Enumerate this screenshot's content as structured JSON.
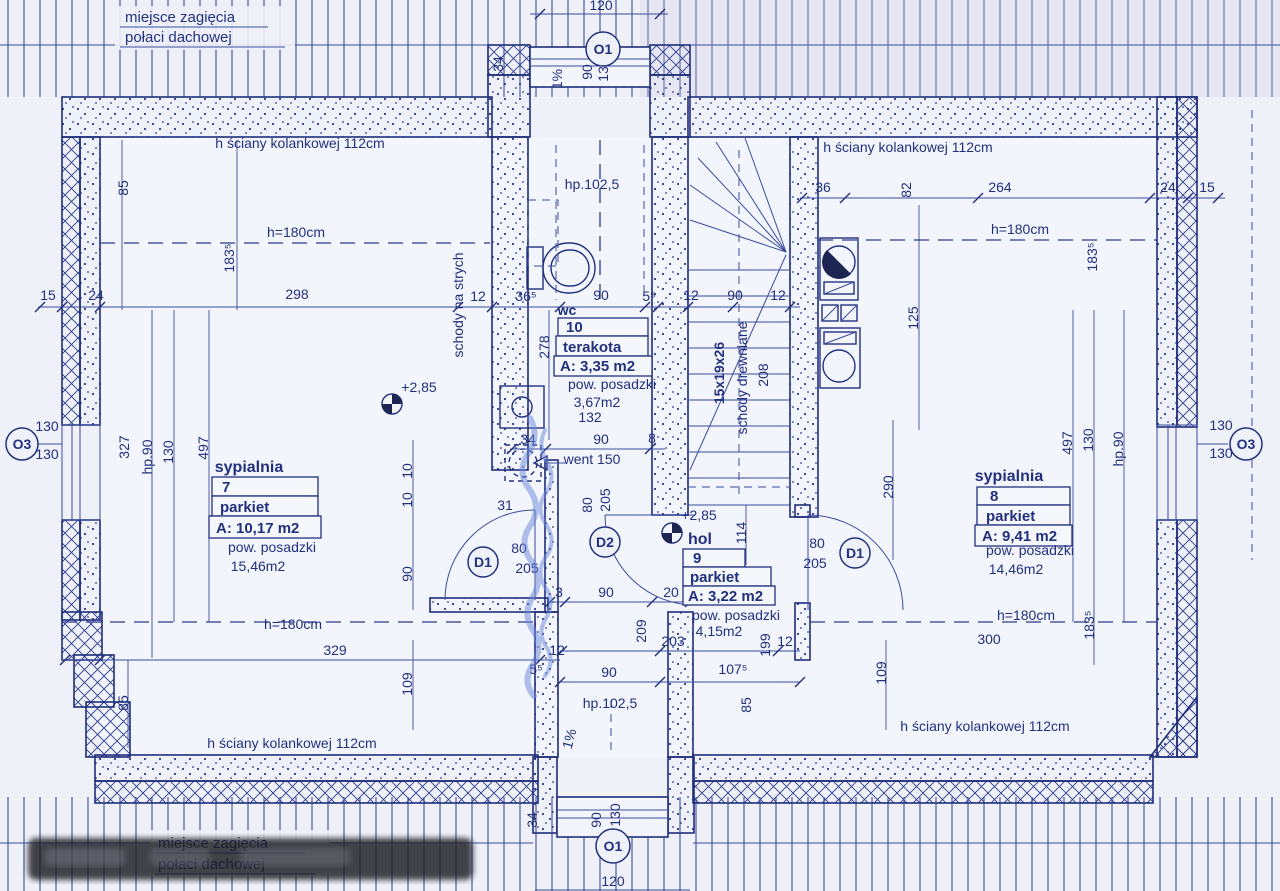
{
  "palette": {
    "paper": "#eef1f8",
    "ink": "#22307e",
    "line_light": "#3c4c9e",
    "watermark_blue": "#6b86d8",
    "redaction_dark": "#1b1c20"
  },
  "corner_notes": {
    "top_line1": "miejsce zagięcia",
    "top_line2": "połaci dachowej",
    "bottom_line1": "miejsce zagięcia",
    "bottom_line2": "połaci dachowej"
  },
  "rooms": [
    {
      "number": "7",
      "name": "sypialnia",
      "floor": "parkiet",
      "area": "A: 10,17 m2",
      "area_label": "pow. posadzki",
      "floor_area": "15,46m2"
    },
    {
      "number": "8",
      "name": "sypialnia",
      "floor": "parkiet",
      "area": "A: 9,41 m2",
      "area_label": "pow. posadzki",
      "floor_area": "14,46m2"
    },
    {
      "number": "9",
      "name": "hol",
      "floor": "parkiet",
      "area": "A: 3,22 m2",
      "area_label": "pow. posadzki",
      "floor_area": "4,15m2"
    },
    {
      "number": "10",
      "name": "wc",
      "floor": "terakota",
      "area": "A: 3,35 m2",
      "area_label": "pow. posadzki",
      "floor_area": "3,67m2"
    }
  ],
  "annotations": [
    {
      "t": "120",
      "x": 601,
      "y": 10,
      "fs": 15
    },
    {
      "t": "90",
      "x": 592,
      "y": 72,
      "r": -90,
      "fs": 15
    },
    {
      "t": "130",
      "x": 608,
      "y": 70,
      "r": -90,
      "fs": 15
    },
    {
      "t": "1%",
      "x": 562,
      "y": 79,
      "r": -90,
      "fs": 14
    },
    {
      "t": "34",
      "x": 503,
      "y": 64,
      "r": -90,
      "fs": 14
    },
    {
      "t": "h ściany kolankowej 112cm",
      "x": 300,
      "y": 148,
      "fs": 15
    },
    {
      "t": "h ściany kolankowej 112cm",
      "x": 908,
      "y": 152,
      "fs": 15
    },
    {
      "t": "hp.102,5",
      "x": 592,
      "y": 189,
      "fs": 15
    },
    {
      "t": "85",
      "x": 128,
      "y": 188,
      "r": -90,
      "fs": 14
    },
    {
      "t": "183⁵",
      "x": 234,
      "y": 258,
      "r": -90,
      "fs": 14
    },
    {
      "t": "h=180cm",
      "x": 296,
      "y": 237,
      "fs": 15
    },
    {
      "t": "h=180cm",
      "x": 1020,
      "y": 234,
      "fs": 15
    },
    {
      "t": "183⁵",
      "x": 1097,
      "y": 257,
      "r": -90,
      "fs": 14
    },
    {
      "t": "36",
      "x": 823,
      "y": 192,
      "fs": 14
    },
    {
      "t": "82",
      "x": 911,
      "y": 190,
      "r": -90,
      "fs": 14
    },
    {
      "t": "264",
      "x": 1000,
      "y": 192,
      "fs": 14
    },
    {
      "t": "24",
      "x": 1168,
      "y": 192,
      "fs": 13
    },
    {
      "t": "15",
      "x": 1207,
      "y": 192,
      "fs": 13
    },
    {
      "t": "15",
      "x": 48,
      "y": 300,
      "fs": 14
    },
    {
      "t": "24",
      "x": 96,
      "y": 300,
      "fs": 14
    },
    {
      "t": "298",
      "x": 297,
      "y": 299,
      "fs": 15
    },
    {
      "t": "12",
      "x": 478,
      "y": 301,
      "fs": 13
    },
    {
      "t": "36⁵",
      "x": 526,
      "y": 301,
      "fs": 13
    },
    {
      "t": "90",
      "x": 601,
      "y": 300,
      "fs": 14
    },
    {
      "t": "5⁵",
      "x": 649,
      "y": 301,
      "fs": 13
    },
    {
      "t": "12",
      "x": 691,
      "y": 300,
      "fs": 13
    },
    {
      "t": "90",
      "x": 735,
      "y": 300,
      "fs": 14
    },
    {
      "t": "12",
      "x": 778,
      "y": 300,
      "fs": 13
    },
    {
      "t": "wc",
      "x": 567,
      "y": 315,
      "fs": 14,
      "b": true
    },
    {
      "t": "schody na strych",
      "x": 463,
      "y": 305,
      "r": -90,
      "fs": 13
    },
    {
      "t": "125",
      "x": 918,
      "y": 318,
      "r": -90,
      "fs": 14
    },
    {
      "t": "290",
      "x": 893,
      "y": 487,
      "r": -90,
      "fs": 14
    },
    {
      "t": "15x19x26",
      "x": 724,
      "y": 373,
      "r": -90,
      "fs": 15,
      "b": true
    },
    {
      "t": "schody drewniane",
      "x": 747,
      "y": 378,
      "r": -90,
      "fs": 13
    },
    {
      "t": "208",
      "x": 768,
      "y": 375,
      "r": -90,
      "fs": 13
    },
    {
      "t": "278",
      "x": 549,
      "y": 347,
      "r": -90,
      "fs": 13
    },
    {
      "t": "hp.90",
      "x": 152,
      "y": 457,
      "r": -90,
      "fs": 13
    },
    {
      "t": "130",
      "x": 173,
      "y": 452,
      "r": -90,
      "fs": 13
    },
    {
      "t": "497",
      "x": 208,
      "y": 448,
      "r": -90,
      "fs": 13
    },
    {
      "t": "327",
      "x": 129,
      "y": 447,
      "r": -90,
      "fs": 13
    },
    {
      "t": "130",
      "x": 47,
      "y": 431,
      "fs": 13
    },
    {
      "t": "130",
      "x": 47,
      "y": 459,
      "fs": 13
    },
    {
      "t": "130",
      "x": 1221,
      "y": 430,
      "fs": 13
    },
    {
      "t": "130",
      "x": 1221,
      "y": 458,
      "fs": 13
    },
    {
      "t": "+2,85",
      "x": 419,
      "y": 392,
      "fs": 15
    },
    {
      "t": "+2,85",
      "x": 699,
      "y": 520,
      "fs": 15
    },
    {
      "t": "10",
      "x": 412,
      "y": 471,
      "r": -90,
      "fs": 12
    },
    {
      "t": "10",
      "x": 412,
      "y": 500,
      "r": -90,
      "fs": 12
    },
    {
      "t": "90",
      "x": 412,
      "y": 574,
      "r": -90,
      "fs": 13
    },
    {
      "t": "31",
      "x": 505,
      "y": 510,
      "fs": 13
    },
    {
      "t": "80",
      "x": 519,
      "y": 553,
      "fs": 13
    },
    {
      "t": "205",
      "x": 527,
      "y": 573,
      "fs": 13
    },
    {
      "t": "34",
      "x": 528,
      "y": 444,
      "fs": 13
    },
    {
      "t": "132",
      "x": 590,
      "y": 422,
      "fs": 13
    },
    {
      "t": "90",
      "x": 601,
      "y": 444,
      "fs": 13
    },
    {
      "t": "8",
      "x": 652,
      "y": 443,
      "fs": 12
    },
    {
      "t": "went 150",
      "x": 592,
      "y": 464,
      "fs": 12
    },
    {
      "t": "205",
      "x": 610,
      "y": 500,
      "r": -90,
      "fs": 13
    },
    {
      "t": "80",
      "x": 592,
      "y": 505,
      "r": -90,
      "fs": 13
    },
    {
      "t": "114",
      "x": 746,
      "y": 533,
      "r": -90,
      "fs": 13
    },
    {
      "t": "3",
      "x": 559,
      "y": 597,
      "fs": 12
    },
    {
      "t": "90",
      "x": 606,
      "y": 597,
      "fs": 13
    },
    {
      "t": "20",
      "x": 671,
      "y": 597,
      "fs": 13
    },
    {
      "t": "209",
      "x": 646,
      "y": 631,
      "r": -90,
      "fs": 13
    },
    {
      "t": "203",
      "x": 673,
      "y": 646,
      "fs": 13
    },
    {
      "t": "199",
      "x": 770,
      "y": 645,
      "r": -90,
      "fs": 12
    },
    {
      "t": "12",
      "x": 785,
      "y": 646,
      "fs": 12
    },
    {
      "t": "80",
      "x": 817,
      "y": 548,
      "fs": 13
    },
    {
      "t": "205",
      "x": 815,
      "y": 568,
      "fs": 13
    },
    {
      "t": "497",
      "x": 1072,
      "y": 443,
      "r": -90,
      "fs": 13
    },
    {
      "t": "130",
      "x": 1093,
      "y": 440,
      "r": -90,
      "fs": 13
    },
    {
      "t": "hp.90",
      "x": 1123,
      "y": 449,
      "r": -90,
      "fs": 13
    },
    {
      "t": "h=180cm",
      "x": 1026,
      "y": 620,
      "fs": 15
    },
    {
      "t": "300",
      "x": 989,
      "y": 644,
      "fs": 15
    },
    {
      "t": "109",
      "x": 886,
      "y": 673,
      "r": -90,
      "fs": 14
    },
    {
      "t": "183⁵",
      "x": 1094,
      "y": 625,
      "r": -90,
      "fs": 13
    },
    {
      "t": "h ściany kolankowej 112cm",
      "x": 985,
      "y": 731,
      "fs": 15
    },
    {
      "t": "h ściany kolankowej 112cm",
      "x": 292,
      "y": 748,
      "fs": 15
    },
    {
      "t": "h=180cm",
      "x": 293,
      "y": 629,
      "fs": 15
    },
    {
      "t": "329",
      "x": 335,
      "y": 655,
      "fs": 14
    },
    {
      "t": "109",
      "x": 412,
      "y": 684,
      "r": -90,
      "fs": 14
    },
    {
      "t": "85",
      "x": 128,
      "y": 703,
      "r": -90,
      "fs": 14
    },
    {
      "t": "5⁵",
      "x": 536,
      "y": 674,
      "fs": 12
    },
    {
      "t": "12",
      "x": 557,
      "y": 655,
      "fs": 12
    },
    {
      "t": "90",
      "x": 609,
      "y": 677,
      "fs": 14
    },
    {
      "t": "107⁵",
      "x": 733,
      "y": 674,
      "fs": 14
    },
    {
      "t": "85",
      "x": 751,
      "y": 705,
      "r": -90,
      "fs": 13
    },
    {
      "t": "hp.102,5",
      "x": 610,
      "y": 708,
      "fs": 15
    },
    {
      "t": "1%",
      "x": 574,
      "y": 740,
      "r": -75,
      "fs": 14
    },
    {
      "t": "90",
      "x": 601,
      "y": 820,
      "r": -90,
      "fs": 14
    },
    {
      "t": "130",
      "x": 620,
      "y": 815,
      "r": -90,
      "fs": 14
    },
    {
      "t": "34",
      "x": 537,
      "y": 820,
      "r": -90,
      "fs": 13
    },
    {
      "t": "120",
      "x": 613,
      "y": 886,
      "fs": 15
    },
    {
      "t": "O1",
      "x": 603,
      "y": 49,
      "circle": 17,
      "fs": 15
    },
    {
      "t": "O1",
      "x": 613,
      "y": 846,
      "circle": 17,
      "fs": 15
    },
    {
      "t": "O3",
      "x": 22,
      "y": 444,
      "circle": 16,
      "fs": 14
    },
    {
      "t": "O3",
      "x": 1246,
      "y": 444,
      "circle": 16,
      "fs": 14
    },
    {
      "t": "D1",
      "x": 483,
      "y": 562,
      "circle": 15,
      "fs": 14
    },
    {
      "t": "D2",
      "x": 605,
      "y": 542,
      "circle": 15,
      "fs": 14
    },
    {
      "t": "D1",
      "x": 855,
      "y": 553,
      "circle": 15,
      "fs": 14
    }
  ]
}
